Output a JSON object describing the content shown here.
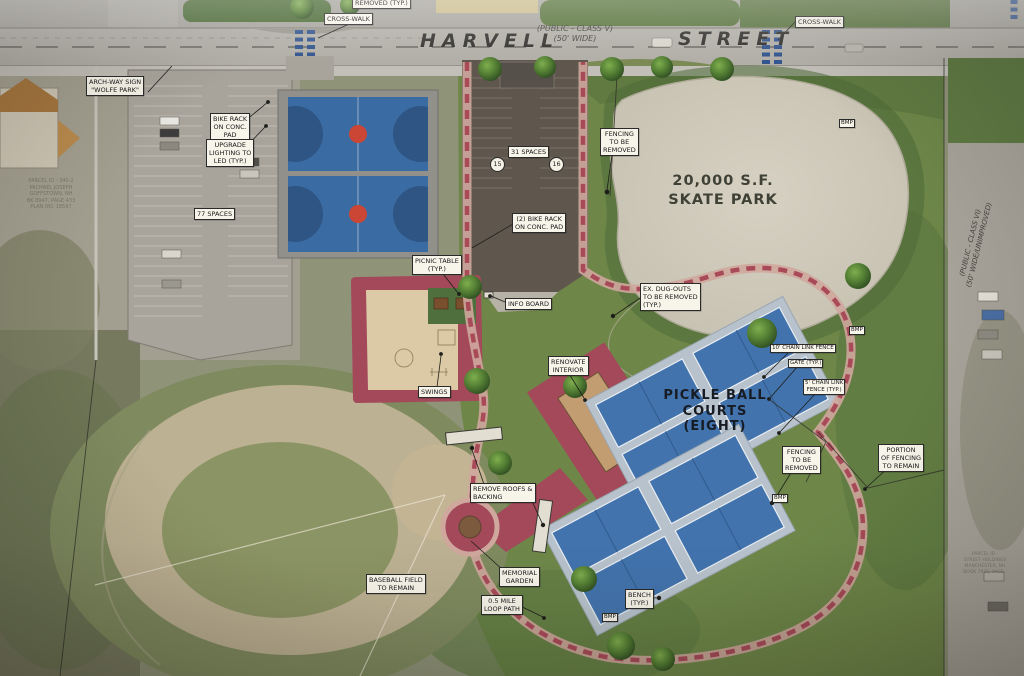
{
  "street": {
    "name_left": "HARVELL",
    "name_right": "STREET",
    "class_note": "(PUBLIC - CLASS V)\n(50' WIDE)",
    "crosswalk_left": "CROSS-WALK",
    "crosswalk_right": "CROSS-WALK",
    "removed_typ": "REMOVED (TYP.)"
  },
  "side_road": {
    "class_note": "(PUBLIC - CLASS VI)\n(50' WIDE/UNIMPROVED)"
  },
  "area_labels": {
    "skate_park": "20,000 S.F.\nSKATE PARK",
    "pickleball": "PICKLE BALL\nCOURTS\n(EIGHT)"
  },
  "callouts": {
    "archway_sign": "ARCH-WAY SIGN\n\"WOLFE PARK\"",
    "bike_rack": "BIKE RACK\nON CONC.\nPAD",
    "upgrade_lighting": "UPGRADE\nLIGHTING TO\nLED (TYP.)",
    "spaces_77": "77 SPACES",
    "spaces_31": "31 SPACES",
    "stall_15": "15",
    "stall_16": "16",
    "bike_rack_2": "(2) BIKE RACK\nON CONC. PAD",
    "fencing_removed": "FENCING\nTO BE\nREMOVED",
    "picnic_table": "PICNIC TABLE\n(TYP.)",
    "info_board": "INFO BOARD",
    "swings": "SWINGS",
    "renovate_interior": "RENOVATE\nINTERIOR",
    "ex_dugouts": "EX. DUG-OUTS\nTO BE REMOVED\n(TYP.)",
    "chain_link_10": "10' CHAIN LINK FENCE",
    "gate": "GATE (TYP.)",
    "chain_link_5": "5' CHAIN LINK\nFENCE (TYP.)",
    "portion_fencing": "PORTION\nOF FENCING\nTO REMAIN",
    "remove_roofs": "REMOVE ROOFS &\nBACKING",
    "memorial_garden": "MEMORIAL\nGARDEN",
    "baseball_field": "BASEBALL FIELD\nTO REMAIN",
    "loop_path": "0.5 MILE\nLOOP PATH",
    "bench": "BENCH\n(TYP.)",
    "bmp": "BMP"
  },
  "faint_text": {
    "left_parcel": "PARCEL ID - 340-2\nMICHAEL JOSEPH\nGOFFSTOWN, NH\nBK 8947, PAGE 433\nPLAN NO. 18597",
    "right_parcel": "PARCEL ID -\nSTREET HOLDINGS\nMANCHESTER, NH\nBOOK 7935, PAGE -"
  },
  "colors": {
    "grass_render": "#6e8749",
    "grass_dark": "#55703c",
    "photo_olive": "#8f9378",
    "street_gray": "#b2afa8",
    "skate_gray": "#ccc7b8",
    "court_blue": "#3a6ca3",
    "court_key_blue": "#2e5584",
    "center_red": "#cc4636",
    "parking_new": "#5f574d",
    "maroon": "#a3495a",
    "sand": "#dcc9a6",
    "pickle_slab": "#b7c2cc",
    "pickle_court": "#4273ad",
    "path_dash_red": "#a84a58",
    "crosswalk_blue": "#33568f",
    "building_tan": "#c29d72"
  }
}
